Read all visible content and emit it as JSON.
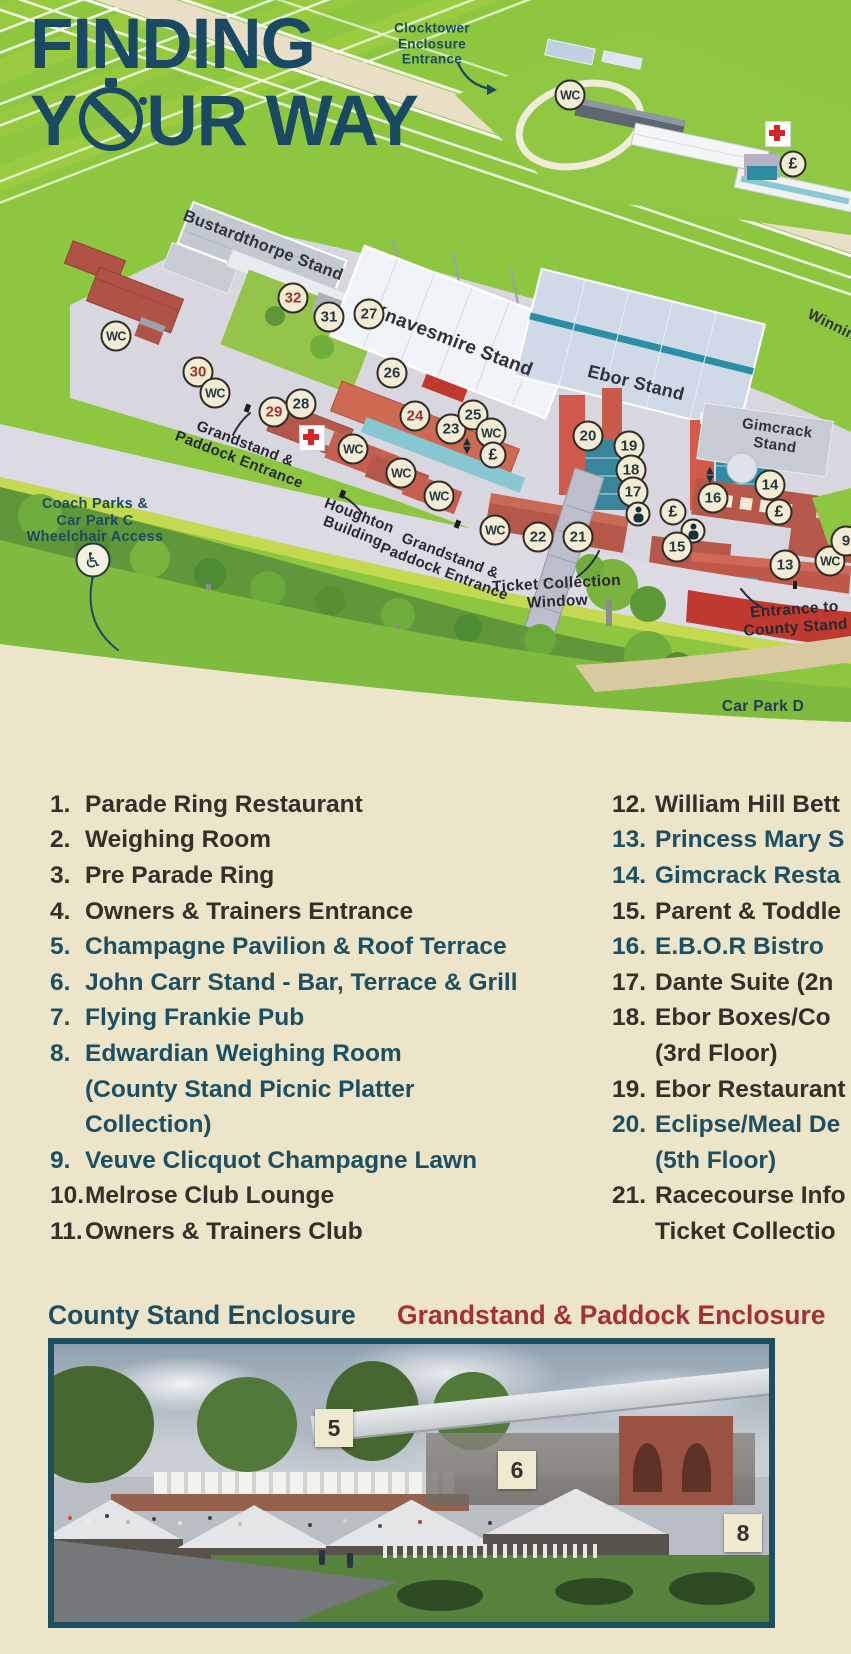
{
  "title": {
    "line1": "FINDING",
    "line2_pre": "Y",
    "line2_post": "UR WAY"
  },
  "colors": {
    "accent_navy": "#1a4a63",
    "legend_teal": "#1d4f63",
    "legend_dark": "#33302a",
    "marker_red": "#a32e31",
    "header_red": "#a5303a",
    "grass_green": "#8dc63f",
    "cream": "#ece5c9"
  },
  "map": {
    "labels": [
      {
        "id": "clocktower-enclosure-entrance",
        "lines": [
          "Clocktower",
          "Enclosure",
          "Entrance"
        ],
        "x": 432,
        "y": 44,
        "rot": 0,
        "size": 13.5,
        "color": "navy"
      },
      {
        "id": "winning-post",
        "lines": [
          "Winning"
        ],
        "x": 836,
        "y": 327,
        "rot": 26,
        "size": 15,
        "color": "charcoal"
      },
      {
        "id": "bustardthorpe-stand",
        "lines": [
          "Bustardthorpe Stand"
        ],
        "x": 263,
        "y": 246,
        "rot": 21,
        "size": 16.5,
        "color": "charcoal"
      },
      {
        "id": "knavesmire-stand",
        "lines": [
          "Knavesmire Stand"
        ],
        "x": 452,
        "y": 341,
        "rot": 21,
        "size": 19,
        "color": "charcoal"
      },
      {
        "id": "ebor-stand",
        "lines": [
          "Ebor Stand"
        ],
        "x": 636,
        "y": 383,
        "rot": 14,
        "size": 18,
        "color": "charcoal"
      },
      {
        "id": "gimcrack-stand",
        "lines": [
          "Gimcrack",
          "Stand"
        ],
        "x": 776,
        "y": 437,
        "rot": 8,
        "size": 15,
        "color": "charcoal"
      },
      {
        "id": "coach-parks",
        "lines": [
          "Coach Parks &",
          "Car Park C",
          "Wheelchair Access"
        ],
        "x": 95,
        "y": 521,
        "rot": 0,
        "size": 14.5,
        "color": "navy"
      },
      {
        "id": "grandstand-paddock-entrance-1",
        "lines": [
          "Grandstand &",
          "Paddock Entrance"
        ],
        "x": 242,
        "y": 452,
        "rot": 21,
        "size": 15,
        "color": "black"
      },
      {
        "id": "houghton-building",
        "lines": [
          "Houghton",
          "Building"
        ],
        "x": 356,
        "y": 524,
        "rot": 21,
        "size": 15,
        "color": "black"
      },
      {
        "id": "grandstand-paddock-entrance-2",
        "lines": [
          "Grandstand &",
          "Paddock Entrance"
        ],
        "x": 447,
        "y": 564,
        "rot": 21,
        "size": 15,
        "color": "black"
      },
      {
        "id": "ticket-collection-window",
        "lines": [
          "Ticket Collection",
          "Window"
        ],
        "x": 557,
        "y": 593,
        "rot": -3,
        "size": 15.5,
        "color": "black"
      },
      {
        "id": "entrance-to-county-stand",
        "lines": [
          "Entrance to",
          "County Stand"
        ],
        "x": 795,
        "y": 619,
        "rot": -4,
        "size": 15.5,
        "color": "black"
      },
      {
        "id": "car-park-d",
        "lines": [
          "Car Park D"
        ],
        "x": 763,
        "y": 707,
        "rot": 0,
        "size": 15.5,
        "color": "navy2"
      }
    ],
    "badges": [
      {
        "kind": "wc",
        "label": "WC",
        "x": 570,
        "y": 95
      },
      {
        "kind": "cross",
        "x": 778,
        "y": 134
      },
      {
        "kind": "pound",
        "label": "£",
        "x": 793,
        "y": 164
      },
      {
        "kind": "num",
        "label": "32",
        "x": 293,
        "y": 298,
        "red": true
      },
      {
        "kind": "num",
        "label": "31",
        "x": 329,
        "y": 317
      },
      {
        "kind": "num",
        "label": "27",
        "x": 369,
        "y": 314
      },
      {
        "kind": "wc",
        "label": "WC",
        "x": 116,
        "y": 336
      },
      {
        "kind": "num",
        "label": "30",
        "x": 198,
        "y": 372,
        "red": true
      },
      {
        "kind": "wc",
        "label": "WC",
        "x": 215,
        "y": 393
      },
      {
        "kind": "num",
        "label": "26",
        "x": 392,
        "y": 373
      },
      {
        "kind": "num",
        "label": "29",
        "x": 274,
        "y": 412,
        "red": true
      },
      {
        "kind": "num",
        "label": "28",
        "x": 301,
        "y": 404
      },
      {
        "kind": "cross",
        "x": 312,
        "y": 438
      },
      {
        "kind": "num",
        "label": "24",
        "x": 415,
        "y": 416,
        "red": true
      },
      {
        "kind": "num",
        "label": "23",
        "x": 451,
        "y": 429
      },
      {
        "kind": "num",
        "label": "25",
        "x": 473,
        "y": 415
      },
      {
        "kind": "wc",
        "label": "WC",
        "x": 491,
        "y": 433
      },
      {
        "kind": "lift",
        "x": 467,
        "y": 446
      },
      {
        "kind": "pound",
        "label": "£",
        "x": 493,
        "y": 455
      },
      {
        "kind": "wc",
        "label": "WC",
        "x": 353,
        "y": 449
      },
      {
        "kind": "wc",
        "label": "WC",
        "x": 401,
        "y": 473
      },
      {
        "kind": "wc",
        "label": "WC",
        "x": 439,
        "y": 496
      },
      {
        "kind": "num",
        "label": "20",
        "x": 588,
        "y": 436
      },
      {
        "kind": "num",
        "label": "19",
        "x": 629,
        "y": 446
      },
      {
        "kind": "num",
        "label": "18",
        "x": 631,
        "y": 470
      },
      {
        "kind": "num",
        "label": "17",
        "x": 633,
        "y": 492
      },
      {
        "kind": "baby",
        "x": 638,
        "y": 514
      },
      {
        "kind": "pound",
        "label": "£",
        "x": 673,
        "y": 512
      },
      {
        "kind": "lift",
        "x": 710,
        "y": 475
      },
      {
        "kind": "num",
        "label": "16",
        "x": 713,
        "y": 498
      },
      {
        "kind": "baby",
        "x": 693,
        "y": 531
      },
      {
        "kind": "num",
        "label": "15",
        "x": 677,
        "y": 547
      },
      {
        "kind": "num",
        "label": "14",
        "x": 770,
        "y": 485
      },
      {
        "kind": "pound",
        "label": "£",
        "x": 779,
        "y": 512
      },
      {
        "kind": "wc",
        "label": "WC",
        "x": 495,
        "y": 530
      },
      {
        "kind": "num",
        "label": "22",
        "x": 538,
        "y": 537
      },
      {
        "kind": "num",
        "label": "21",
        "x": 578,
        "y": 537
      },
      {
        "kind": "num",
        "label": "13",
        "x": 785,
        "y": 565
      },
      {
        "kind": "wc",
        "label": "WC",
        "x": 830,
        "y": 561
      },
      {
        "kind": "num",
        "label": "9",
        "x": 846,
        "y": 541
      },
      {
        "kind": "wheelchair",
        "label": "♿",
        "x": 93,
        "y": 560
      }
    ]
  },
  "legend": {
    "left": [
      {
        "n": "1.",
        "t": "Parade Ring Restaurant",
        "c": "dark"
      },
      {
        "n": "2.",
        "t": "Weighing Room",
        "c": "dark"
      },
      {
        "n": "3.",
        "t": "Pre Parade Ring",
        "c": "dark"
      },
      {
        "n": "4.",
        "t": "Owners & Trainers Entrance",
        "c": "dark"
      },
      {
        "n": "5.",
        "t": "Champagne Pavilion & Roof Terrace",
        "c": "teal"
      },
      {
        "n": "6.",
        "t": "John Carr Stand - Bar, Terrace & Grill",
        "c": "teal"
      },
      {
        "n": "7.",
        "t": "Flying Frankie Pub",
        "c": "teal"
      },
      {
        "n": "8.",
        "t": "Edwardian Weighing Room",
        "c": "teal"
      },
      {
        "n": "",
        "t": "(County Stand Picnic Platter",
        "c": "teal"
      },
      {
        "n": "",
        "t": "Collection)",
        "c": "teal"
      },
      {
        "n": "9.",
        "t": "Veuve Clicquot Champagne Lawn",
        "c": "teal"
      },
      {
        "n": "10.",
        "t": "Melrose Club Lounge",
        "c": "dark"
      },
      {
        "n": "11.",
        "t": "Owners & Trainers Club",
        "c": "dark"
      }
    ],
    "right": [
      {
        "n": "12.",
        "t": "William Hill Bett",
        "c": "dark"
      },
      {
        "n": "13.",
        "t": "Princess Mary S",
        "c": "teal"
      },
      {
        "n": "14.",
        "t": "Gimcrack Resta",
        "c": "teal"
      },
      {
        "n": "15.",
        "t": "Parent & Toddle",
        "c": "dark"
      },
      {
        "n": "16.",
        "t": "E.B.O.R Bistro",
        "c": "teal"
      },
      {
        "n": "17.",
        "t": "Dante Suite (2n",
        "c": "dark"
      },
      {
        "n": "18.",
        "t": "Ebor Boxes/Co",
        "c": "dark"
      },
      {
        "n": "",
        "t": "(3rd Floor)",
        "c": "dark"
      },
      {
        "n": "19.",
        "t": "Ebor Restaurant",
        "c": "dark"
      },
      {
        "n": "20.",
        "t": "Eclipse/Meal De",
        "c": "teal"
      },
      {
        "n": "",
        "t": "(5th Floor)",
        "c": "teal"
      },
      {
        "n": "21.",
        "t": "Racecourse Info",
        "c": "dark"
      },
      {
        "n": "",
        "t": "Ticket Collectio",
        "c": "dark"
      }
    ]
  },
  "sections": {
    "county_header": "County Stand Enclosure",
    "grandstand_header": "Grandstand & Paddock Enclosure"
  },
  "photo": {
    "badges": [
      {
        "label": "5",
        "x": 286,
        "y": 90
      },
      {
        "label": "6",
        "x": 469,
        "y": 132
      },
      {
        "label": "8",
        "x": 695,
        "y": 195
      }
    ]
  }
}
